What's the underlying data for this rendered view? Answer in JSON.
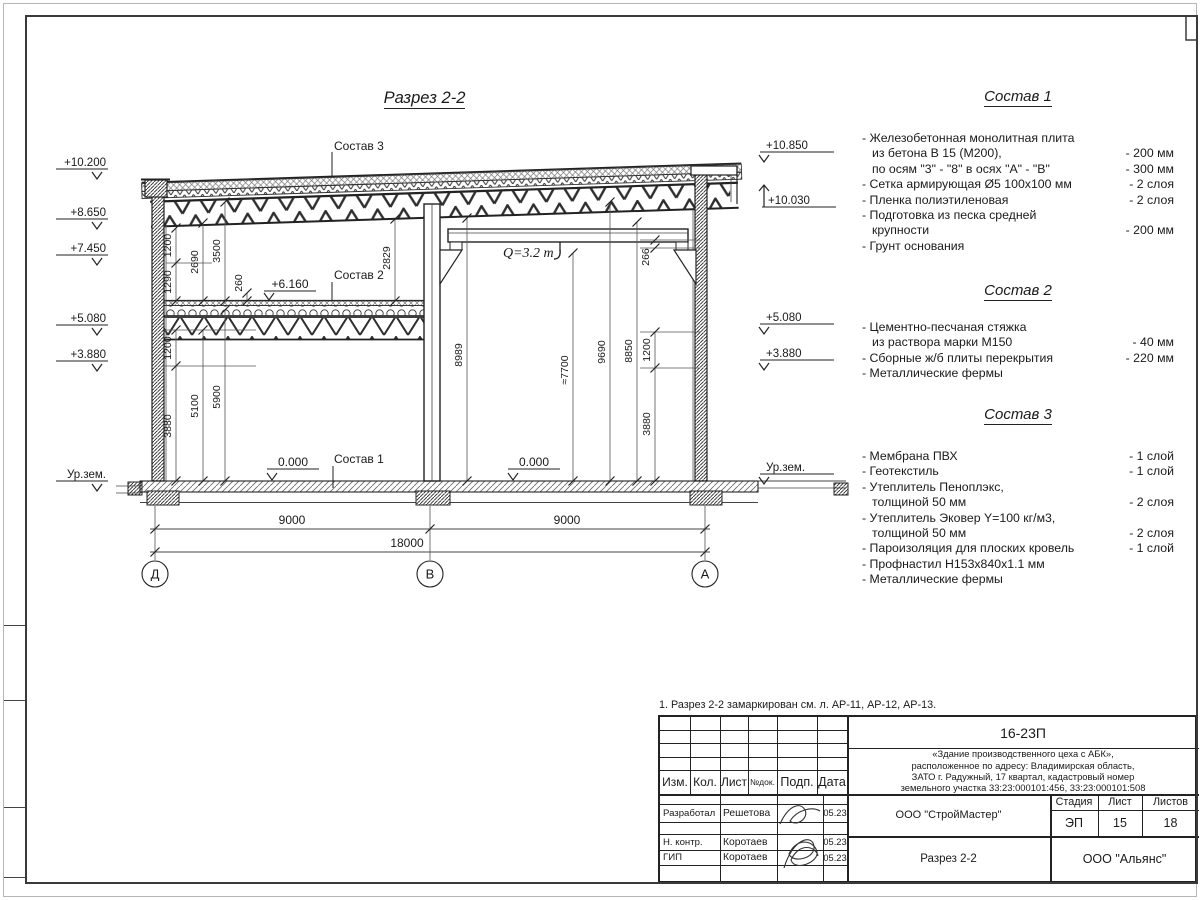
{
  "page": {
    "drawing_title": "Разрез 2-2",
    "note": "1. Разрез 2-2 замаркирован см. л. АР-11, АР-12, АР-13."
  },
  "compositions": [
    {
      "title": "Состав 1",
      "rows": [
        {
          "t": "- Железобетонная  монолитная плита",
          "v": ""
        },
        {
          "t": "из бетона В 15 (М200),",
          "v": "- 200 мм"
        },
        {
          "t": "по осям \"3\" - \"8\" в осях \"А\" - \"В\"",
          "v": "- 300 мм"
        },
        {
          "t": "- Сетка армирующая Ø5 100х100 мм",
          "v": "- 2 слоя"
        },
        {
          "t": "- Пленка полиэтиленовая",
          "v": "-  2 слоя"
        },
        {
          "t": "- Подготовка из песка средней",
          "v": ""
        },
        {
          "t": "крупности",
          "v": "- 200 мм"
        },
        {
          "t": "- Грунт основания",
          "v": ""
        }
      ]
    },
    {
      "title": "Состав 2",
      "rows": [
        {
          "t": "- Цементно-песчаная стяжка",
          "v": ""
        },
        {
          "t": "из раствора марки М150",
          "v": "- 40 мм"
        },
        {
          "t": "- Сборные ж/б плиты перекрытия",
          "v": "- 220 мм"
        },
        {
          "t": "- Металлические фермы",
          "v": ""
        }
      ]
    },
    {
      "title": "Состав 3",
      "rows": [
        {
          "t": "- Мембрана ПВХ",
          "v": "- 1 слой"
        },
        {
          "t": "- Геотекстиль",
          "v": "- 1 слой"
        },
        {
          "t": "- Утеплитель Пеноплэкс,",
          "v": ""
        },
        {
          "t": "толщиной 50 мм",
          "v": "- 2 слоя"
        },
        {
          "t": "- Утеплитель Эковер Y=100 кг/м3,",
          "v": ""
        },
        {
          "t": "толщиной 50 мм",
          "v": "- 2 слоя"
        },
        {
          "t": "- Пароизоляция для плоских кровель",
          "v": "- 1 слой"
        },
        {
          "t": "- Профнастил Н153х840х1.1 мм",
          "v": ""
        },
        {
          "t": "- Металлические фермы",
          "v": ""
        }
      ]
    }
  ],
  "marks": {
    "left": [
      "+10.200",
      "+8.650",
      "+7.450",
      "+5.080",
      "+3.880",
      "Ур.зем."
    ],
    "right": [
      "+10.850",
      "+10.030",
      "+5.080",
      "+3.880",
      "Ур.зем."
    ]
  },
  "labels": {
    "sostav3": "Состав 3",
    "sostav2": "Состав 2",
    "sostav1": "Состав 1",
    "lvl6160": "+6.160",
    "zero_left": "0.000",
    "zero_right": "0.000",
    "crane": "Q=3.2 т"
  },
  "dims": {
    "d1200a": "1200",
    "d1290": "1290",
    "d2690": "2690",
    "d3500": "3500",
    "d260": "260",
    "d2829": "2829",
    "d1200b": "1200",
    "d3880l": "3880",
    "d5100": "5100",
    "d5900": "5900",
    "d266": "266",
    "d8989": "8989",
    "d7700": "≈7700",
    "d9690": "9690",
    "d8850": "8850",
    "d1200r": "1200",
    "d3880r": "3880",
    "b9000a": "9000",
    "b9000b": "9000",
    "b18000": "18000"
  },
  "axes": [
    "Д",
    "В",
    "А"
  ],
  "titleblock": {
    "doc_number": "16-23П",
    "object_lines": [
      "«Здание производственного цеха с АБК»,",
      "расположенное по адресу: Владимирская область,",
      "ЗАТО г. Радужный, 17 квартал, кадастровый номер",
      "земельного участка 33:23:000101:456, 33:23:000101:508"
    ],
    "org1": "ООО \"СтройМастер\"",
    "sheet_title": "Разрез 2-2",
    "org2": "ООО \"Альянс\"",
    "cols": {
      "izm": "Изм.",
      "kol": "Кол.",
      "list": "Лист",
      "ndok": "№док.",
      "podp": "Подп.",
      "data": "Дата"
    },
    "stage": {
      "h1": "Стадия",
      "h2": "Лист",
      "h3": "Листов",
      "v1": "ЭП",
      "v2": "15",
      "v3": "18"
    },
    "people": [
      {
        "role": "Разработал",
        "name": "Решетова",
        "date": "05.23"
      },
      {
        "role": "Н. контр.",
        "name": "Коротаев",
        "date": "05.23"
      },
      {
        "role": "ГИП",
        "name": "Коротаев",
        "date": "05.23"
      }
    ]
  }
}
